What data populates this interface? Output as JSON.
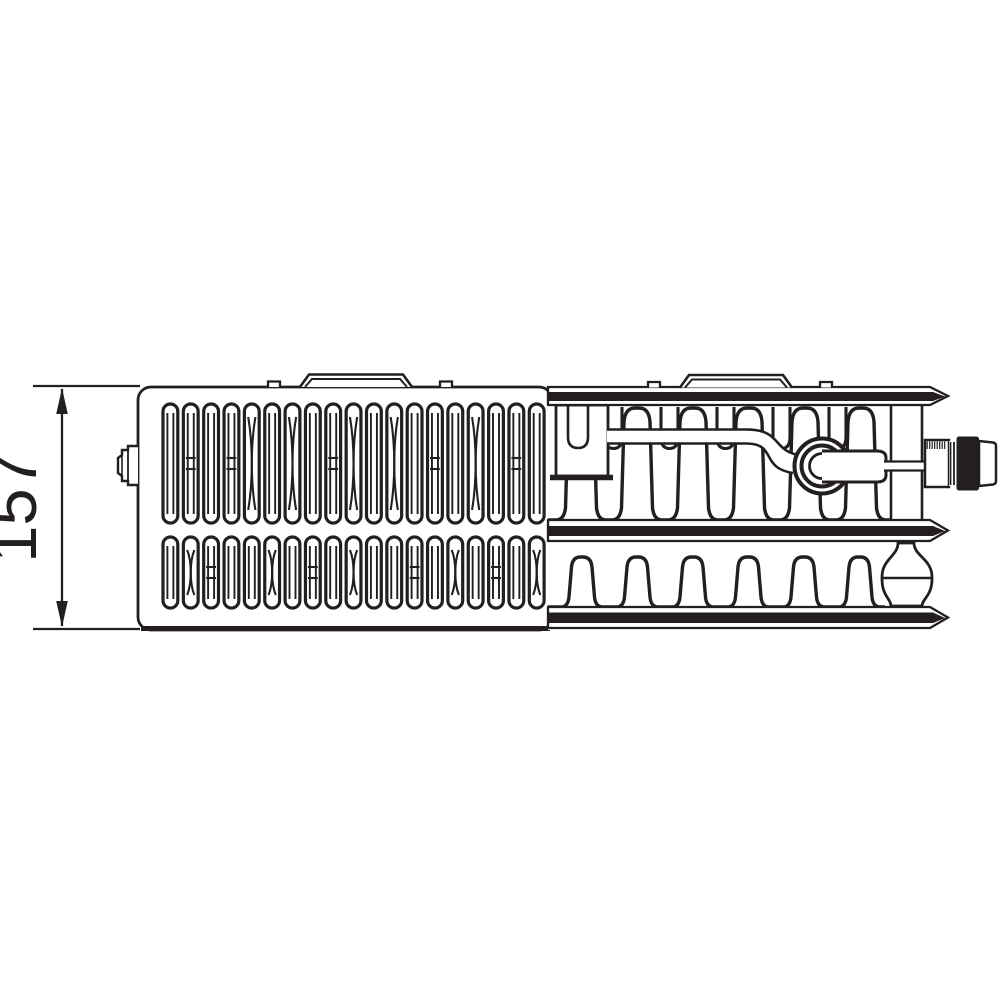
{
  "page": {
    "background": "#ffffff",
    "ink_color": "#231f20",
    "kind": "technical-drawing"
  },
  "dimension": {
    "label": "157",
    "orientation": "vertical"
  },
  "diagram": {
    "subject": "panel-radiator-top-view",
    "sections": [
      "grille-top-view",
      "cutaway-section"
    ],
    "grille": {
      "slot_rows": 2,
      "slots_per_row": 19
    },
    "cutaway": {
      "panel_bands": 3,
      "fin_rows": 2,
      "fin_arches_per_row": 6
    },
    "fittings": [
      "left-valve-spindle",
      "crossover-pipe",
      "valve-insert-ring",
      "right-valve-connection"
    ],
    "brackets": 2
  }
}
